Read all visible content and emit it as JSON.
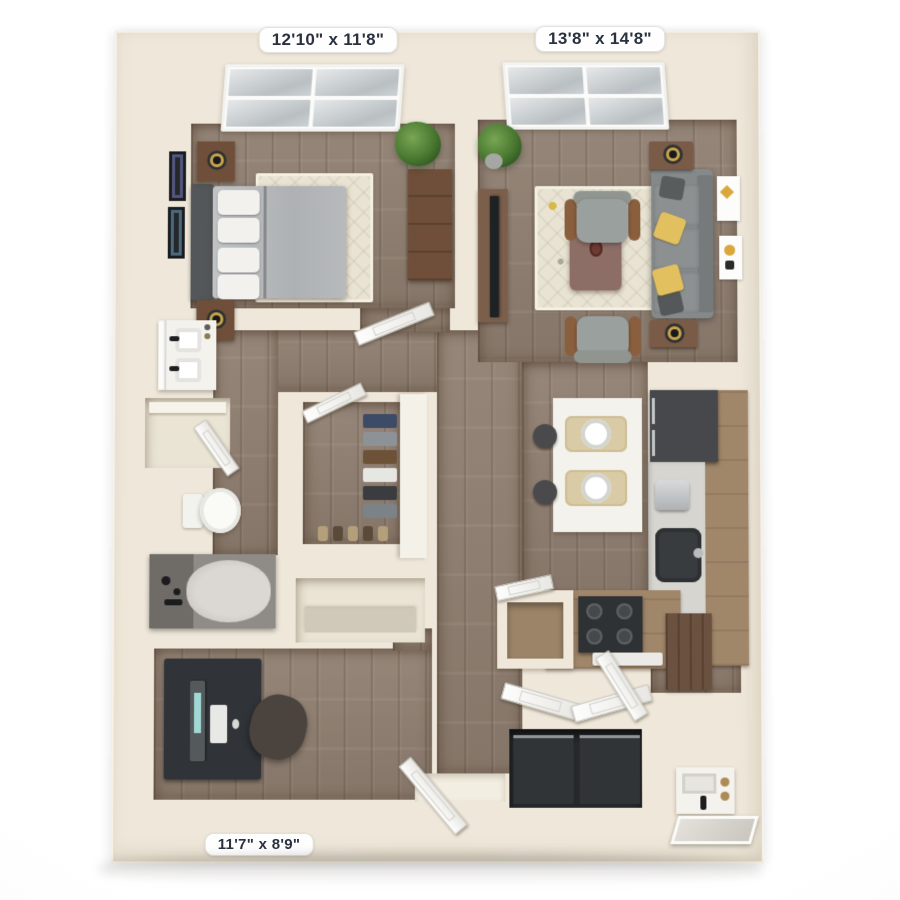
{
  "image_type": "3D top-down rendering of a one-bedroom apartment floor plan",
  "labels": {
    "bedroom": "12'10\" x 11'8\"",
    "living_room": "13'8\" x 14'8\"",
    "den": "11'7\" x 8'9\""
  },
  "rooms": [
    {
      "id": "bedroom",
      "dimension_label": "12'10\" x 11'8\""
    },
    {
      "id": "living-room",
      "dimension_label": "13'8\" x 14'8\""
    },
    {
      "id": "den-office",
      "dimension_label": "11'7\" x 8'9\""
    },
    {
      "id": "bathroom",
      "dimension_label": ""
    },
    {
      "id": "walk-in-closet",
      "dimension_label": ""
    },
    {
      "id": "kitchen",
      "dimension_label": ""
    },
    {
      "id": "laundry-closet",
      "dimension_label": ""
    },
    {
      "id": "entry",
      "dimension_label": ""
    }
  ],
  "palette": {
    "wall": "#efe8da",
    "floor_wood": "#8e7d6f",
    "label_text": "#2a3240",
    "label_bg": "#ffffff",
    "sofa_gray": "#85898a",
    "accent_yellow": "#e2c05f",
    "cabinet_wood": "#a1876a",
    "appliance_dark": "#303438",
    "counter_gray": "#d6d5d0",
    "plant_green": "#47772f"
  }
}
